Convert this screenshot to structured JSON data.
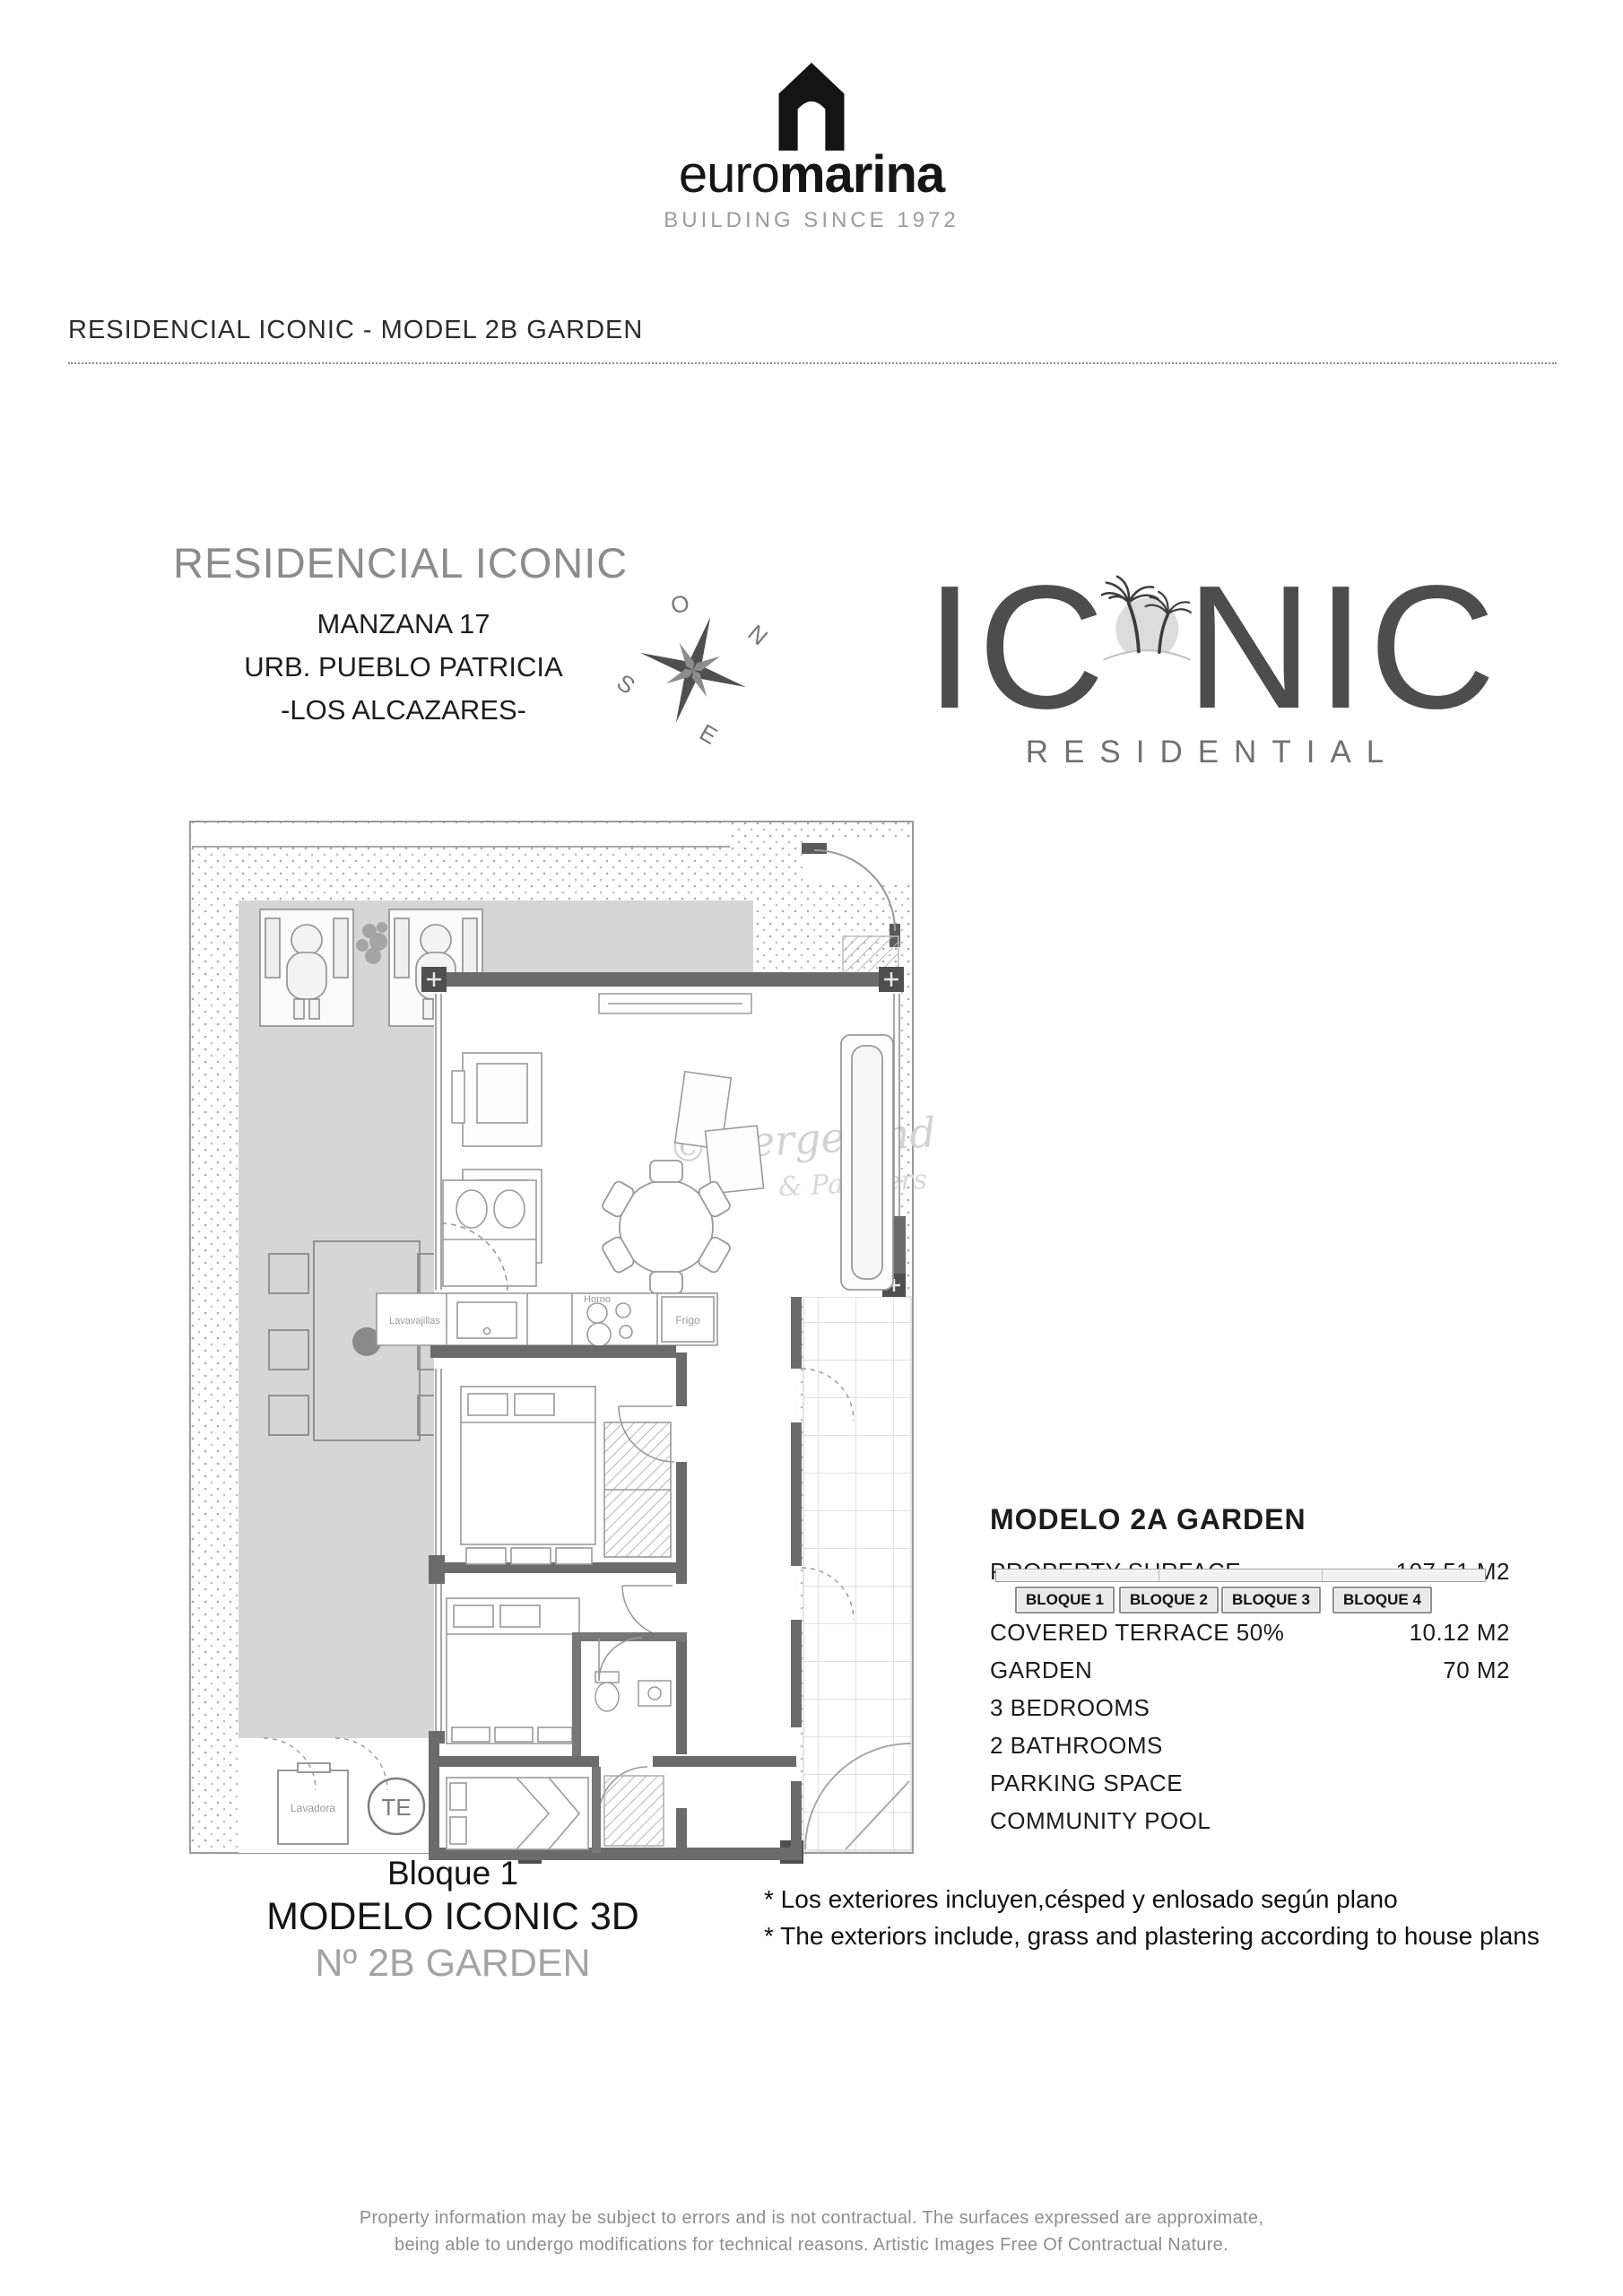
{
  "brand": {
    "euro": "euro",
    "marina": "marina",
    "tagline": "BUILDING SINCE 1972"
  },
  "page_title": "RESIDENCIAL ICONIC - MODEL 2B GARDEN",
  "project": {
    "name": "RESIDENCIAL ICONIC",
    "address_line1": "MANZANA 17",
    "address_line2": "URB. PUEBLO PATRICIA",
    "address_line3": "-LOS ALCAZARES-",
    "compass": {
      "top": "O",
      "right": "N",
      "left": "S",
      "bottom": "E"
    }
  },
  "iconic_logo": {
    "left": "IC",
    "right": "NIC",
    "subtitle": "RESIDENTIAL"
  },
  "floorplan": {
    "watermark": {
      "symbol": "©",
      "line1": "Wergeland",
      "line2": "& Partners"
    },
    "labels": {
      "dishwasher": "Lavavajillas",
      "oven": "Horno",
      "fridge": "Frigo",
      "washer": "Lavadora",
      "water_heater": "TE"
    }
  },
  "details": {
    "title": "MODELO 2A GARDEN",
    "bloque_buttons": [
      "BLOQUE 1",
      "BLOQUE 2",
      "BLOQUE 3",
      "BLOQUE 4"
    ],
    "rows": [
      {
        "label": "PROPERTY SURFACE",
        "value": "107.51 M2"
      },
      {
        "label": "COVERED TERRACE  50%",
        "value": "10.12 M2"
      },
      {
        "label": "GARDEN",
        "value": "70 M2"
      },
      {
        "label": "3 BEDROOMS",
        "value": ""
      },
      {
        "label": "2 BATHROOMS",
        "value": ""
      },
      {
        "label": "PARKING SPACE",
        "value": ""
      },
      {
        "label": "COMMUNITY POOL",
        "value": ""
      }
    ]
  },
  "caption": {
    "line1": "Bloque 1",
    "line2": "MODELO ICONIC 3D",
    "line3": "Nº 2B GARDEN"
  },
  "footnotes": [
    "* Los exteriores incluyen,césped y enlosado según plano",
    "* The exteriors include, grass and plastering according to house plans"
  ],
  "footer": {
    "line1": "Property information may be subject to errors and is not contractual. The surfaces expressed are approximate,",
    "line2": "being able to undergo modifications for technical reasons. Artistic Images Free Of Contractual Nature."
  }
}
